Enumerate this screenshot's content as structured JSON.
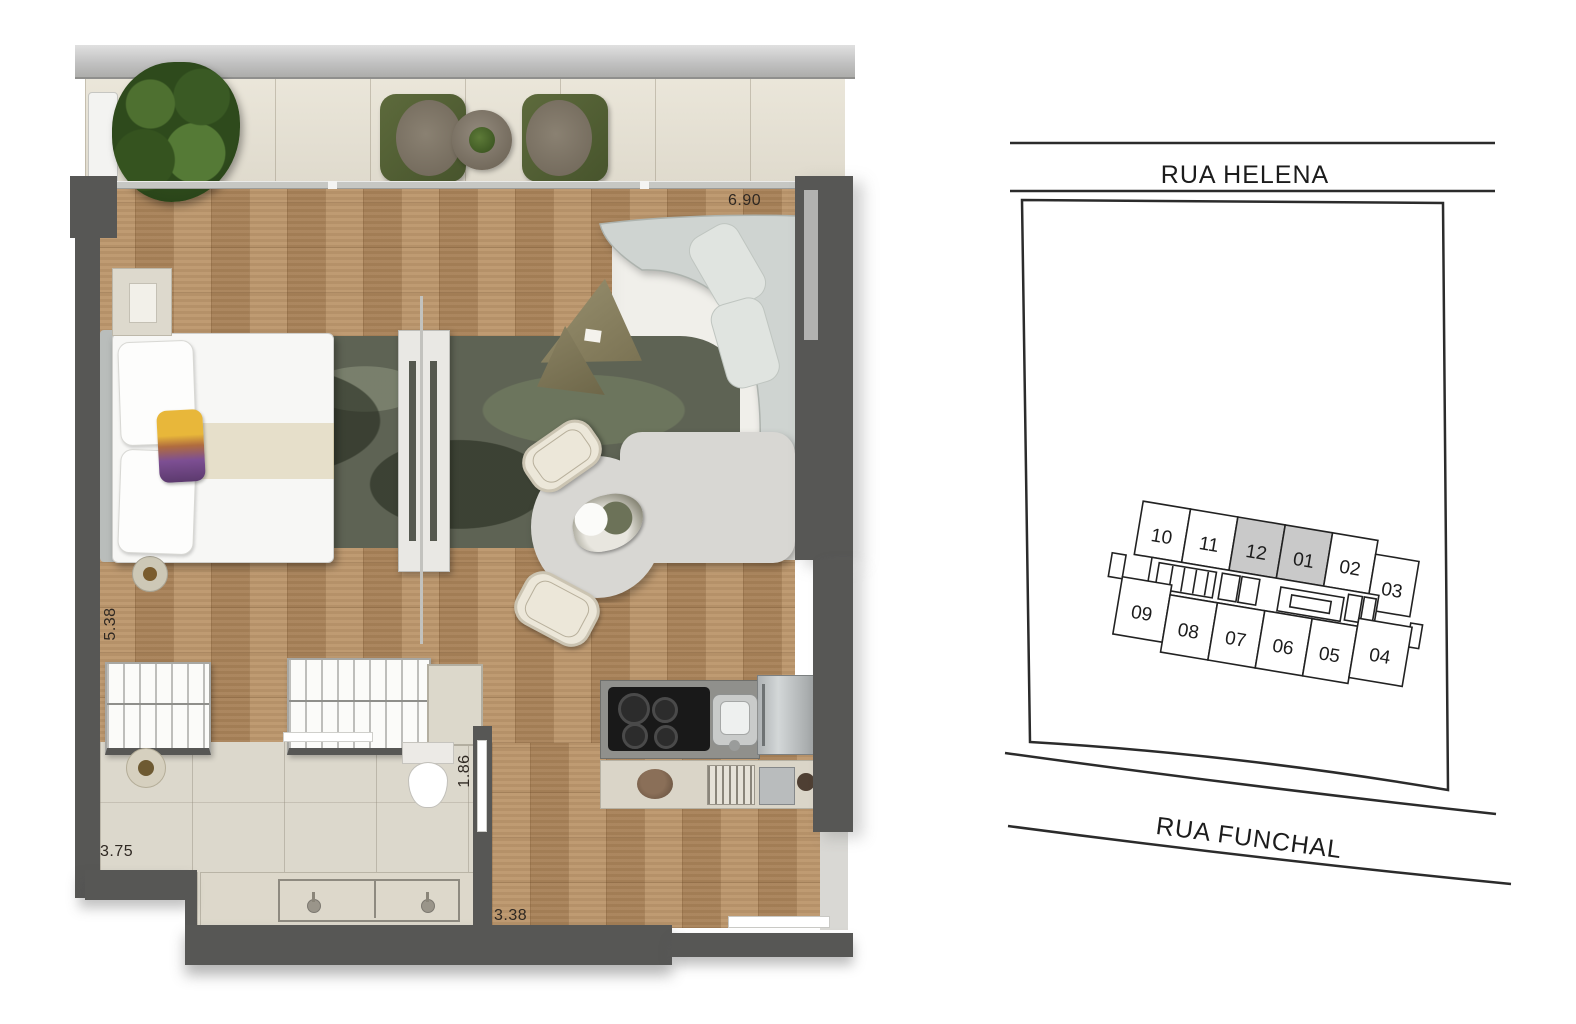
{
  "floorplan": {
    "dim_top": "6.90",
    "dim_left": "5.38",
    "dim_bath_door": "1.86",
    "dim_bath_width": "3.75",
    "dim_bottom": "3.38"
  },
  "siteplan": {
    "street_top": "RUA HELENA",
    "street_bottom": "RUA FUNCHAL",
    "units": [
      {
        "label": "10",
        "fill": "#ffffff"
      },
      {
        "label": "11",
        "fill": "#ffffff"
      },
      {
        "label": "12",
        "fill": "#c9c9c9"
      },
      {
        "label": "01",
        "fill": "#c9c9c9"
      },
      {
        "label": "02",
        "fill": "#ffffff"
      },
      {
        "label": "03",
        "fill": "#ffffff"
      },
      {
        "label": "09",
        "fill": "#ffffff"
      },
      {
        "label": "08",
        "fill": "#ffffff"
      },
      {
        "label": "07",
        "fill": "#ffffff"
      },
      {
        "label": "06",
        "fill": "#ffffff"
      },
      {
        "label": "05",
        "fill": "#ffffff"
      },
      {
        "label": "04",
        "fill": "#ffffff"
      }
    ]
  },
  "colors": {
    "wall": "#575755",
    "wood_floor": "#b48c61",
    "balcony_tile": "#e8e3d5",
    "bath_tile": "#dcd8cc",
    "living_floor": "#f0efea",
    "rug": "#5e6354",
    "unit_highlight": "#c9c9c9"
  }
}
